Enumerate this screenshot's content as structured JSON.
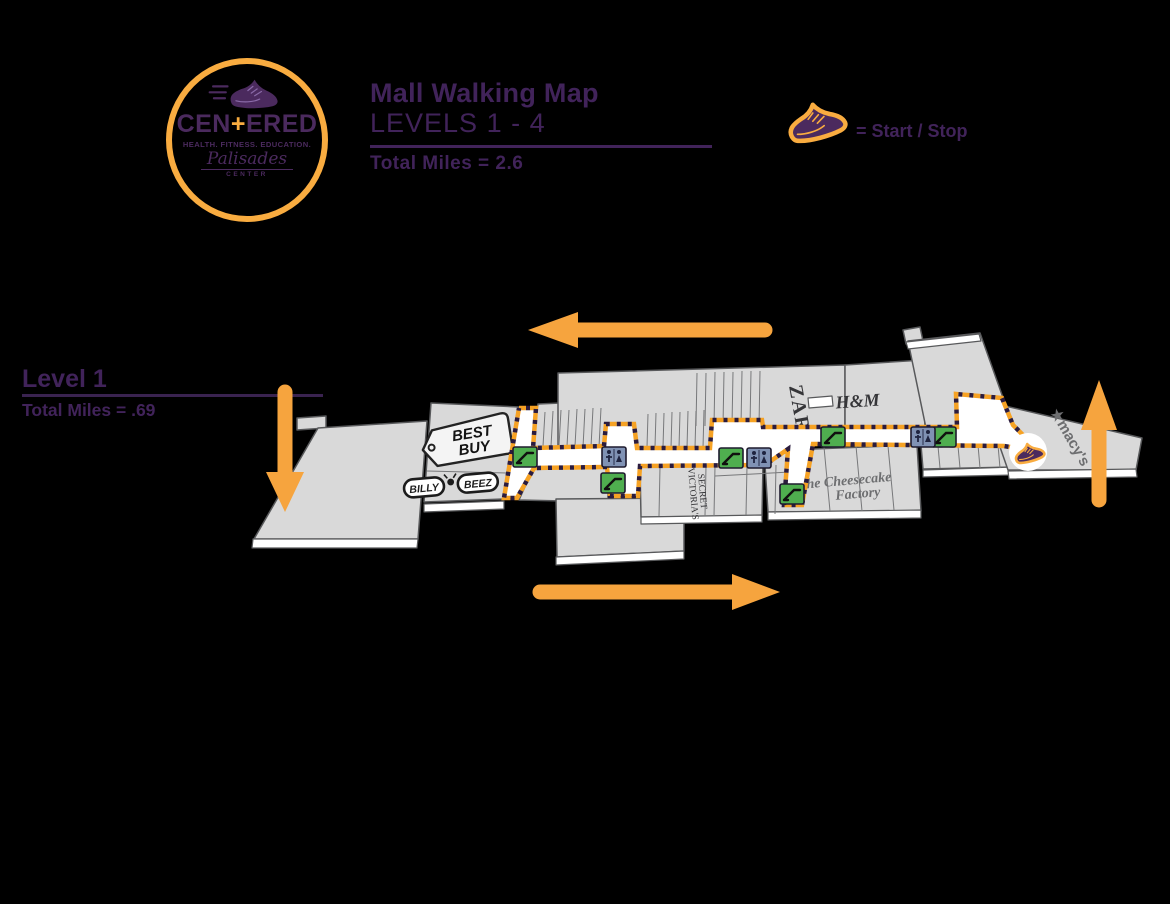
{
  "colors": {
    "purple": "#41235a",
    "orange": "#f6a43e",
    "building_fill": "#d9d9d9",
    "building_stroke": "#58595b",
    "route_dash_orange": "#f6a224",
    "route_dash_dark": "#2b1b3d",
    "escalator_green": "#4fae4f",
    "restroom_blue": "#8092b4"
  },
  "header": {
    "logo": {
      "shoe_icon": "running-shoe",
      "brand_left": "CEN",
      "brand_plus": "+",
      "brand_right": "ERED",
      "tagline": "HEALTH. FITNESS. EDUCATION.",
      "venue": "Palisades",
      "venue_sub": "CENTER"
    },
    "title": "Mall Walking Map",
    "subtitle": "LEVELS 1 - 4",
    "total_miles": "Total Miles = 2.6",
    "legend": {
      "shoe_icon": "running-shoe",
      "label": "= Start / Stop"
    }
  },
  "level_panel": {
    "label": "Level 1",
    "total_miles": "Total Miles = .69"
  },
  "map": {
    "stores": {
      "best_buy": {
        "line1": "BEST",
        "line2": "BUY"
      },
      "billy_beez": {
        "word1": "BILLY",
        "word2": "BEEZ"
      },
      "zara": "ZARA",
      "hm": "H&M",
      "victorias_secret": {
        "line1": "VICTORIA'S",
        "line2": "SECRET"
      },
      "cheesecake_factory": {
        "line1": "The Cheesecake",
        "line2": "Factory"
      },
      "macys": "★macy's"
    },
    "icons": {
      "escalator": "escalator-icon",
      "restroom": "restroom-icon",
      "start_stop": "start-stop-shoe-icon"
    },
    "route": {
      "description": "dashed orange and black walking loop",
      "start_stop_marker": "shoe"
    },
    "arrows": [
      {
        "direction": "left"
      },
      {
        "direction": "down"
      },
      {
        "direction": "right"
      },
      {
        "direction": "up"
      }
    ]
  }
}
